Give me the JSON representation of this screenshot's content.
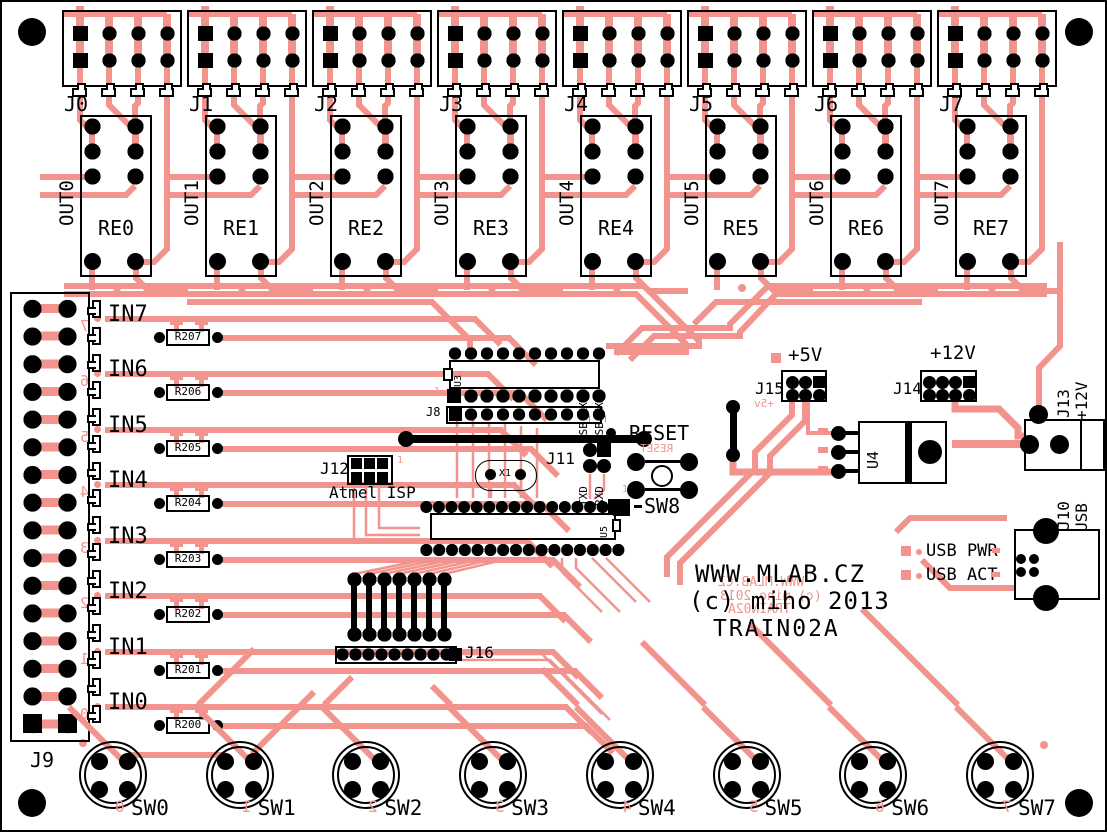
{
  "board_name": "TRAIN02A",
  "colors": {
    "copper": "#f2948d",
    "silkscreen": "#000000",
    "background": "#ffffff"
  },
  "title_block": {
    "line1": "WWW.MLAB.CZ",
    "line2": "(c) miho 2013",
    "line3": "TRAIN02A",
    "mirror1": "WWW.MLAB.CZ",
    "mirror2": "(c) miho 2013",
    "mirror3": "TRAIN02A"
  },
  "channels": [
    {
      "connector": "J0",
      "relay": "RE0",
      "output": "OUT0"
    },
    {
      "connector": "J1",
      "relay": "RE1",
      "output": "OUT1"
    },
    {
      "connector": "J2",
      "relay": "RE2",
      "output": "OUT2"
    },
    {
      "connector": "J3",
      "relay": "RE3",
      "output": "OUT3"
    },
    {
      "connector": "J4",
      "relay": "RE4",
      "output": "OUT4"
    },
    {
      "connector": "J5",
      "relay": "RE5",
      "output": "OUT5"
    },
    {
      "connector": "J6",
      "relay": "RE6",
      "output": "OUT6"
    },
    {
      "connector": "J7",
      "relay": "RE7",
      "output": "OUT7"
    }
  ],
  "inputs": [
    {
      "label": "IN7",
      "resistor": "R207",
      "mirror_digit": "7"
    },
    {
      "label": "IN6",
      "resistor": "R206",
      "mirror_digit": "6"
    },
    {
      "label": "IN5",
      "resistor": "R205",
      "mirror_digit": "5"
    },
    {
      "label": "IN4",
      "resistor": "R204",
      "mirror_digit": "4"
    },
    {
      "label": "IN3",
      "resistor": "R203",
      "mirror_digit": "3"
    },
    {
      "label": "IN2",
      "resistor": "R202",
      "mirror_digit": "2"
    },
    {
      "label": "IN1",
      "resistor": "R201",
      "mirror_digit": "1"
    },
    {
      "label": "IN0",
      "resistor": "R200",
      "mirror_digit": "0"
    }
  ],
  "switches": [
    {
      "label": "SW0",
      "mirror_digit": "0"
    },
    {
      "label": "SW1",
      "mirror_digit": "1"
    },
    {
      "label": "SW2",
      "mirror_digit": "2"
    },
    {
      "label": "SW3",
      "mirror_digit": "3"
    },
    {
      "label": "SW4",
      "mirror_digit": "4"
    },
    {
      "label": "SW5",
      "mirror_digit": "5"
    },
    {
      "label": "SW6",
      "mirror_digit": "6"
    },
    {
      "label": "SW7",
      "mirror_digit": "7"
    }
  ],
  "left_connector": {
    "label": "J9"
  },
  "ics": {
    "u3": "U3",
    "u4": "U4",
    "u5": "U5"
  },
  "headers": {
    "j8": "J8",
    "j8_pin1": "1",
    "j11": "J11",
    "j12": "J12",
    "j12_pin1": "1",
    "j13": "J13",
    "j13_voltage": "+12V",
    "j14": "J14",
    "j15": "J15",
    "j16": "J16",
    "j10": "J10",
    "j10_type": "USB",
    "sw8_pin1": "1"
  },
  "labels": {
    "atmel_isp": "Atmel ISP",
    "x1": "X1",
    "usb_rxd": "USB_RXD",
    "usb_txd": "USB_TXD",
    "txd": "TXD",
    "rxd": "RXD",
    "reset": "RESET",
    "reset_mirror": "RESET",
    "sw8": "SW8",
    "p5v": "+5V",
    "p5v_mirror": "+5v",
    "p12v": "+12V",
    "usb_pwr": "USB PWR",
    "usb_act": "USB ACT"
  }
}
